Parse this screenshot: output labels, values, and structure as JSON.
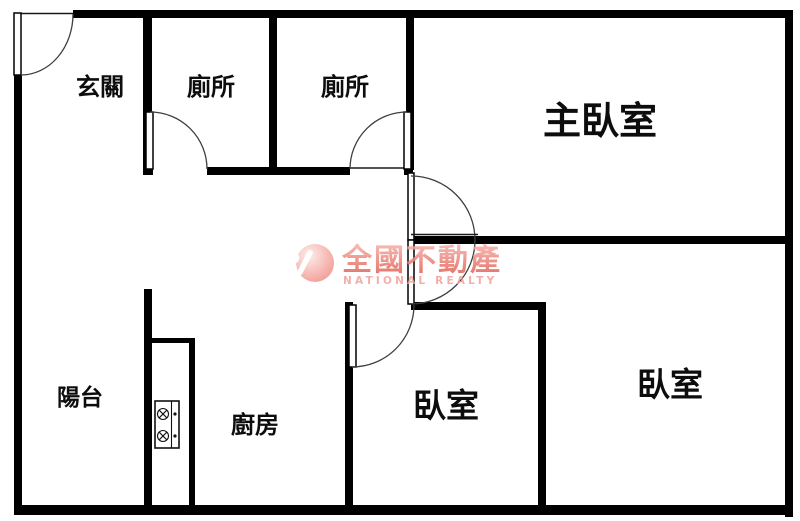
{
  "rooms": {
    "entry": {
      "label": "玄關"
    },
    "toilet_left": {
      "label": "廁所"
    },
    "toilet_right": {
      "label": "廁所"
    },
    "master_bedroom": {
      "label": "主臥室"
    },
    "balcony": {
      "label": "陽台"
    },
    "kitchen": {
      "label": "廚房"
    },
    "bedroom_middle": {
      "label": "臥室"
    },
    "bedroom_right": {
      "label": "臥室"
    }
  },
  "watermark": {
    "logo_letter": "R",
    "brand_name": "全國不動產",
    "brand_name_en": "NATIONAL REALTY"
  },
  "colors": {
    "wall": "#000000",
    "door_arc": "#3f3f3f",
    "watermark_light": "#f6b2ab",
    "watermark_dark": "#e05548",
    "watermark_en": "#f0a29b",
    "logo_circle_light": "#fdeae7",
    "logo_circle_dark": "#f0837b"
  }
}
